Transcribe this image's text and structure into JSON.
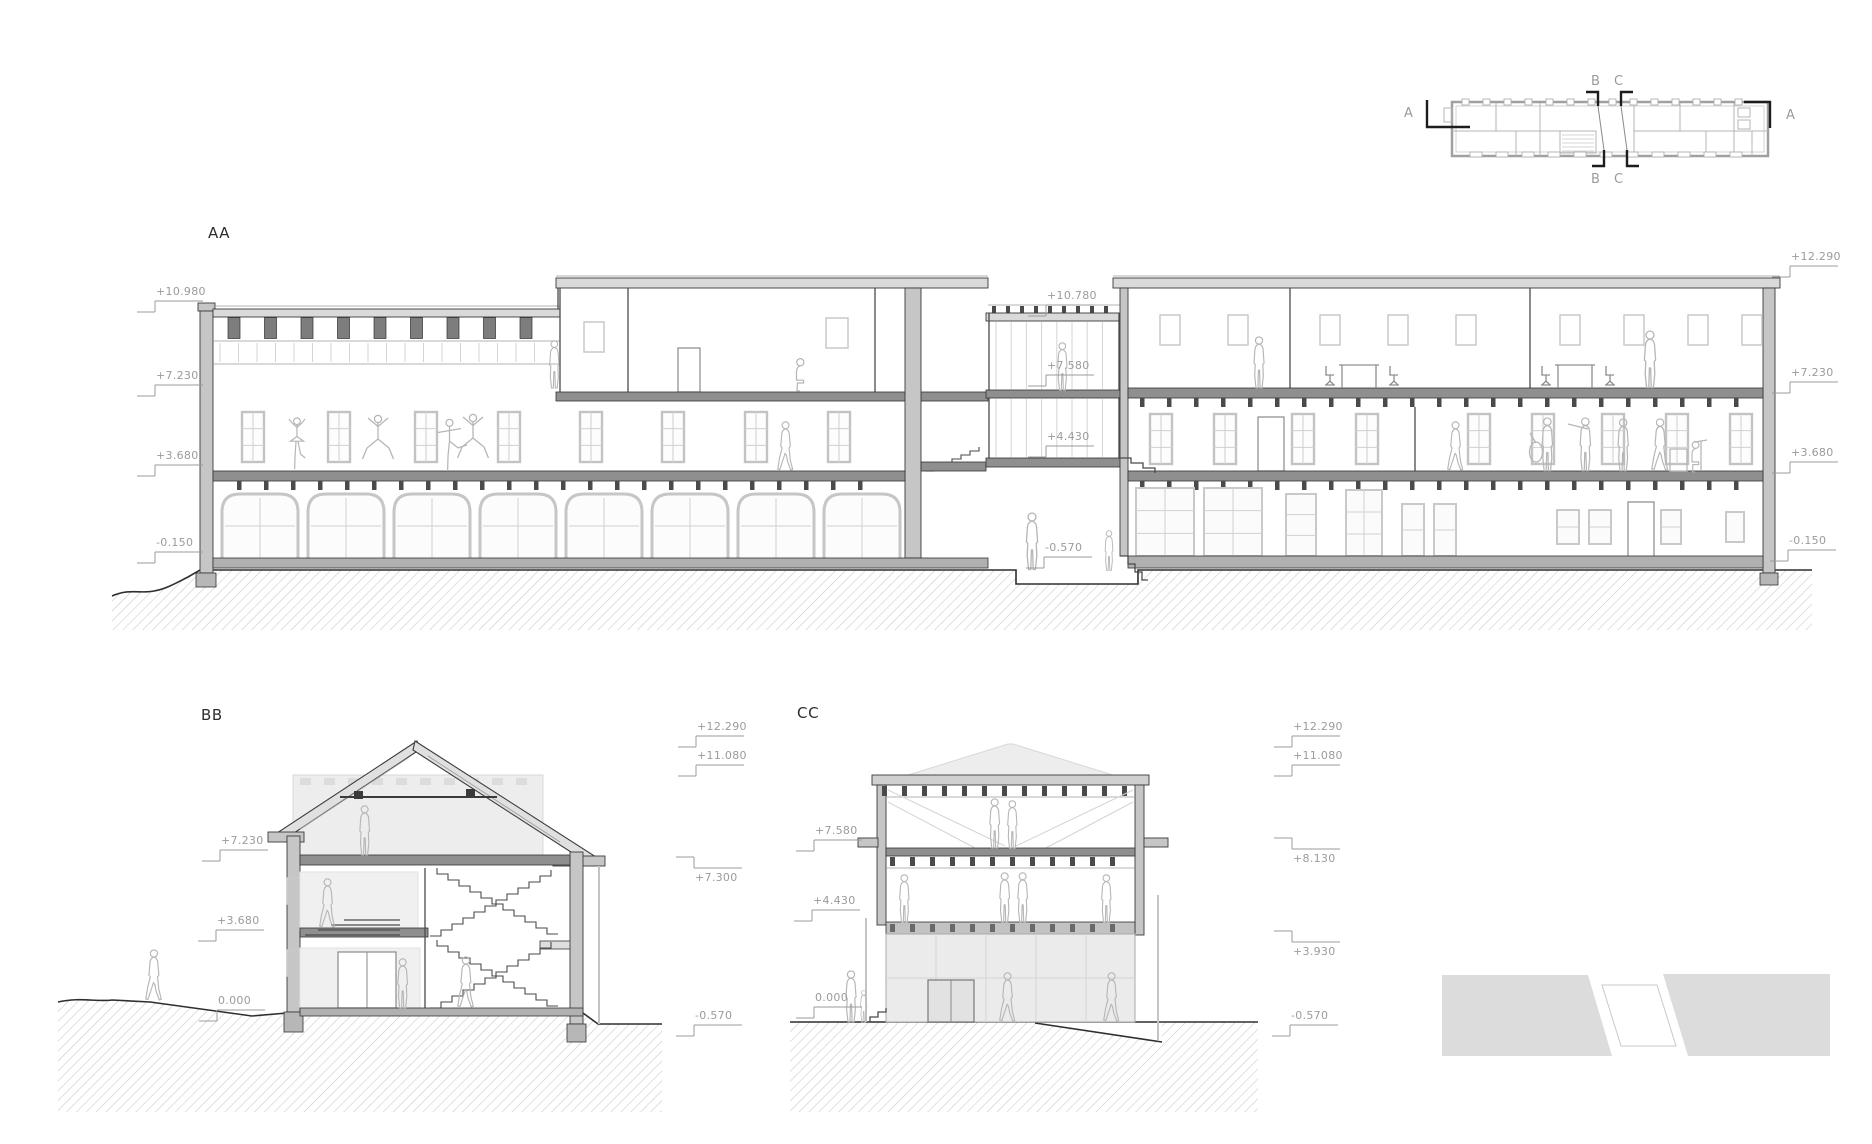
{
  "sections": {
    "aa": {
      "title": "AA",
      "markers": [
        {
          "text": "+10.980",
          "x": 135,
          "y": 285
        },
        {
          "text": "+7.230",
          "x": 135,
          "y": 369
        },
        {
          "text": "+3.680",
          "x": 135,
          "y": 449
        },
        {
          "text": "-0.150",
          "x": 135,
          "y": 536
        },
        {
          "text": "+10.780",
          "x": 1026,
          "y": 289
        },
        {
          "text": "+7.580",
          "x": 1026,
          "y": 359
        },
        {
          "text": "+4.430",
          "x": 1026,
          "y": 430
        },
        {
          "text": "-0.570",
          "x": 1024,
          "y": 541
        },
        {
          "text": "+12.290",
          "x": 1770,
          "y": 250
        },
        {
          "text": "+7.230",
          "x": 1770,
          "y": 366
        },
        {
          "text": "+3.680",
          "x": 1770,
          "y": 446
        },
        {
          "text": "-0.150",
          "x": 1768,
          "y": 534
        }
      ]
    },
    "bb": {
      "title": "BB",
      "markers": [
        {
          "text": "+7.230",
          "x": 200,
          "y": 834
        },
        {
          "text": "+3.680",
          "x": 196,
          "y": 914
        },
        {
          "text": "0.000",
          "x": 197,
          "y": 994
        },
        {
          "text": "+12.290",
          "x": 676,
          "y": 720
        },
        {
          "text": "+11.080",
          "x": 676,
          "y": 749
        },
        {
          "text": "+7.300",
          "x": 674,
          "y": 855,
          "flip": true
        },
        {
          "text": "-0.570",
          "x": 674,
          "y": 1009
        }
      ]
    },
    "cc": {
      "title": "CC",
      "markers": [
        {
          "text": "+7.580",
          "x": 794,
          "y": 824
        },
        {
          "text": "+4.430",
          "x": 792,
          "y": 894
        },
        {
          "text": "0.000",
          "x": 794,
          "y": 991
        },
        {
          "text": "+12.290",
          "x": 1272,
          "y": 720
        },
        {
          "text": "+11.080",
          "x": 1272,
          "y": 749
        },
        {
          "text": "+8.130",
          "x": 1272,
          "y": 836,
          "flip": true
        },
        {
          "text": "+3.930",
          "x": 1272,
          "y": 929,
          "flip": true
        },
        {
          "text": "-0.570",
          "x": 1270,
          "y": 1009
        }
      ]
    }
  },
  "key_plan": {
    "labels": [
      {
        "text": "A",
        "x": 1404,
        "y": 106
      },
      {
        "text": "A",
        "x": 1786,
        "y": 108
      },
      {
        "text": "B",
        "x": 1591,
        "y": 74
      },
      {
        "text": "C",
        "x": 1614,
        "y": 74
      },
      {
        "text": "B",
        "x": 1591,
        "y": 172
      },
      {
        "text": "C",
        "x": 1614,
        "y": 172
      }
    ]
  },
  "colors": {
    "cut_wall": "#c6c6c6",
    "floor_slab": "#8f8f8f",
    "roof_slab": "#dadada",
    "hatch_line": "#c8c8c8",
    "label_gray": "#9b9b9b",
    "figure_gray": "#b6b6b6"
  }
}
